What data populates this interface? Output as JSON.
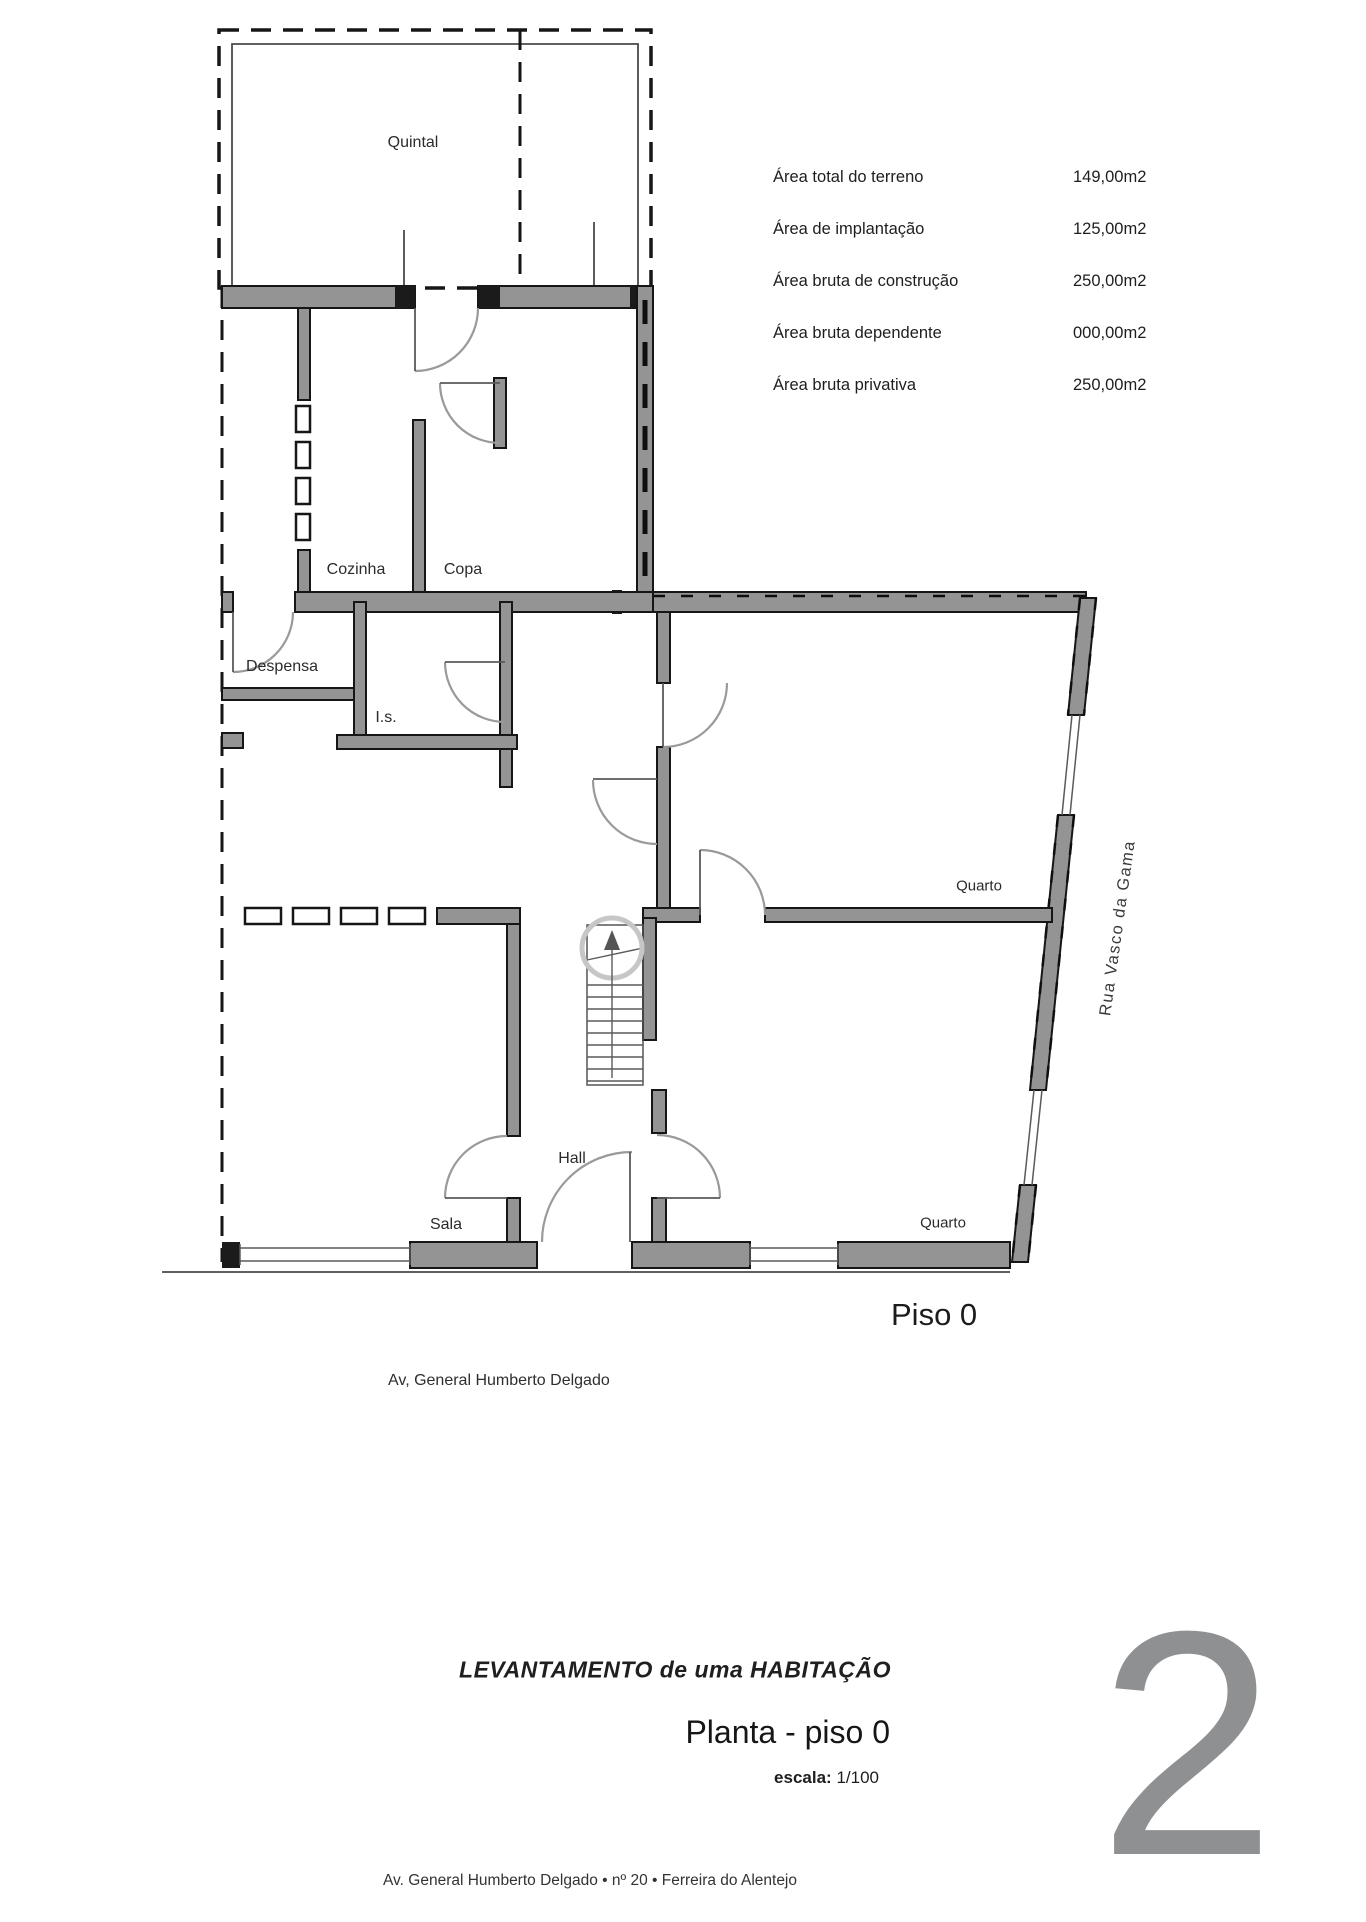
{
  "page": {
    "floor_label": "Piso 0",
    "sheet_number": "2"
  },
  "rooms": {
    "quintal": "Quintal",
    "cozinha": "Cozinha",
    "copa": "Copa",
    "despensa": "Despensa",
    "is": "I.s.",
    "quarto_top": "Quarto",
    "quarto_bottom": "Quarto",
    "hall": "Hall",
    "sala": "Sala"
  },
  "streets": {
    "bottom": "Av, General Humberto Delgado",
    "right": "Rua Vasco da Gama"
  },
  "areas": {
    "rows": [
      {
        "label": "Área total do terreno",
        "value": "149,00m2"
      },
      {
        "label": "Área de implantação",
        "value": "125,00m2"
      },
      {
        "label": "Área bruta de construção",
        "value": "250,00m2"
      },
      {
        "label": "Área bruta dependente",
        "value": "000,00m2"
      },
      {
        "label": "Área bruta privativa",
        "value": "250,00m2"
      }
    ]
  },
  "title_block": {
    "project_title": "LEVANTAMENTO de uma HABITAÇÃO",
    "drawing_title": "Planta - piso 0",
    "scale_label": "escala:",
    "scale_value": "1/100",
    "address_footer": "Av. General Humberto Delgado • nº 20 • Ferreira do Alentejo"
  },
  "colors": {
    "wall_gray": "#949494",
    "line_black": "#161616",
    "sheet_number_gray": "#8f9092"
  }
}
